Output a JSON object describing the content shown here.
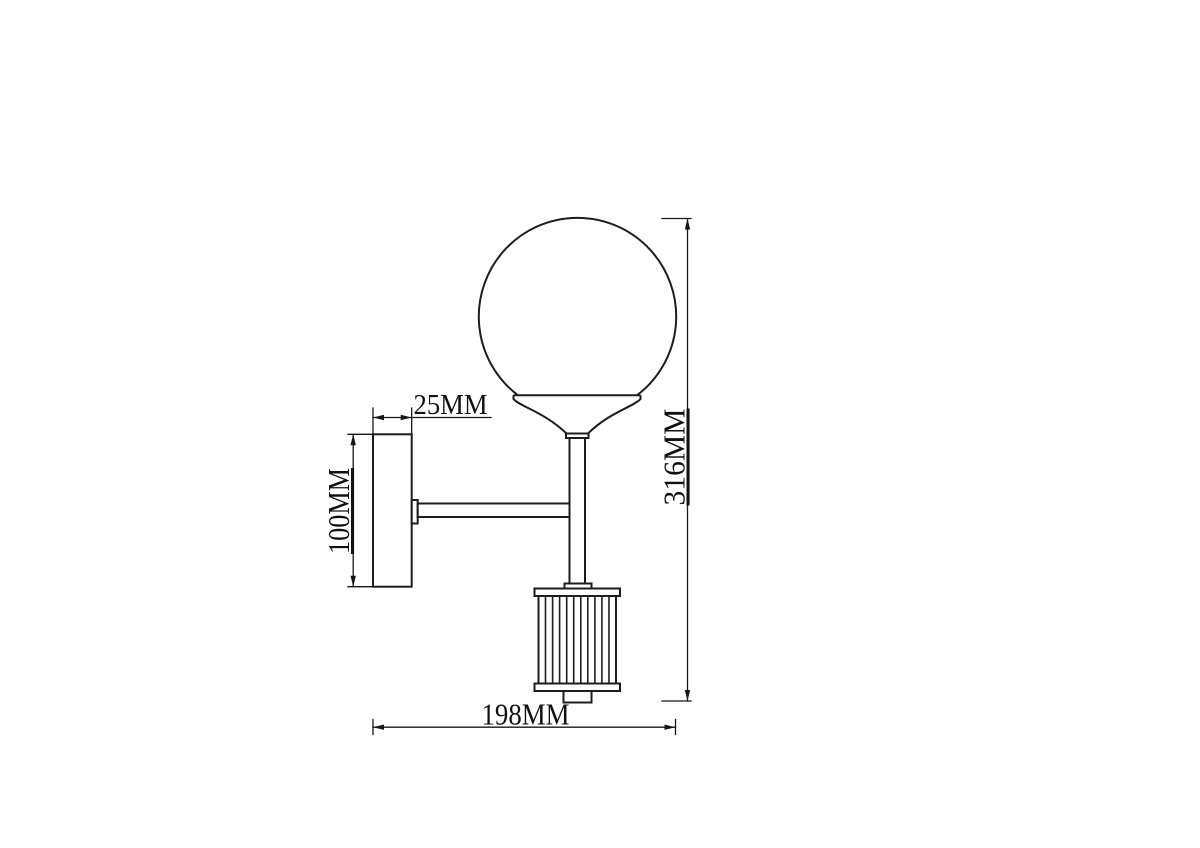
{
  "canvas": {
    "background": "#ffffff",
    "ink_color": "#1d1d1d"
  },
  "drawing": {
    "subject": "wall-lamp-side-elevation-technical-drawing",
    "unit": "MM",
    "labels": {
      "plate_depth": "25MM",
      "plate_height": "100MM",
      "overall_height": "316MM",
      "projection": "198MM"
    },
    "dimensions": [
      {
        "id": "plate_depth",
        "label": "25MM",
        "value_mm": 25,
        "measures": "wall plate depth"
      },
      {
        "id": "plate_height",
        "label": "100MM",
        "value_mm": 100,
        "measures": "wall plate height"
      },
      {
        "id": "overall_height",
        "label": "316MM",
        "value_mm": 316,
        "measures": "overall fixture height"
      },
      {
        "id": "projection",
        "label": "198MM",
        "value_mm": 198,
        "measures": "overall projection from wall"
      }
    ]
  }
}
